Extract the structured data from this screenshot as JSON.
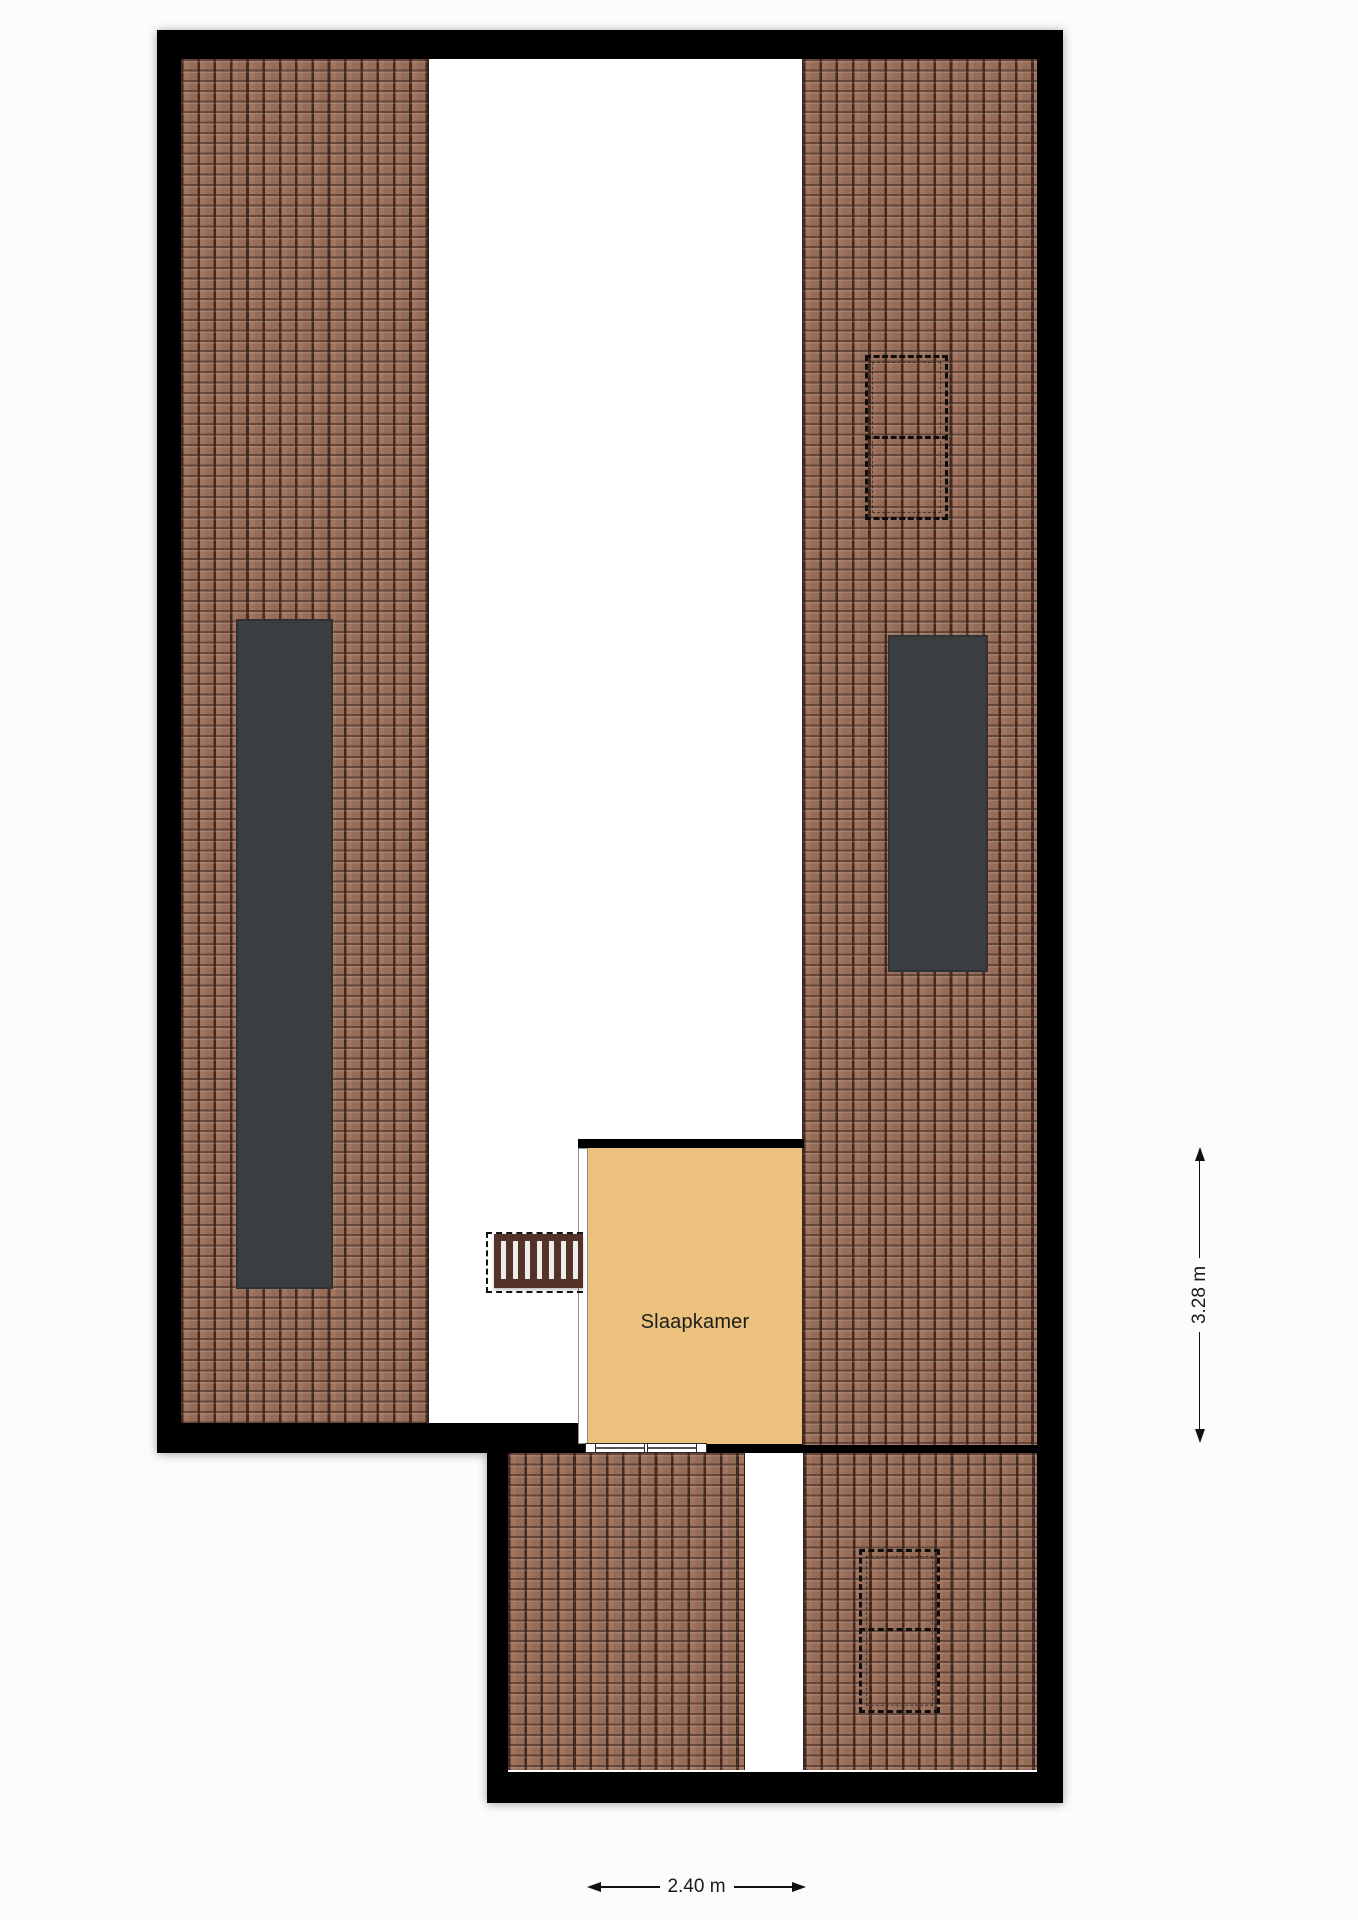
{
  "floorplan": {
    "room": {
      "label": "Slaapkamer"
    },
    "dimensions": {
      "vertical": "3.28 m",
      "horizontal": "2.40 m"
    }
  },
  "colors": {
    "background": "#fcfcfc",
    "wall": "#000000",
    "floor": "#ffffff",
    "roof_tile": "#a0745f",
    "roof_joint": "#3c241c",
    "room_fill": "#ebc17d",
    "skylight": "#3b3e41",
    "stair_wood": "#54322a",
    "dimension_text": "#1a1a1a"
  }
}
